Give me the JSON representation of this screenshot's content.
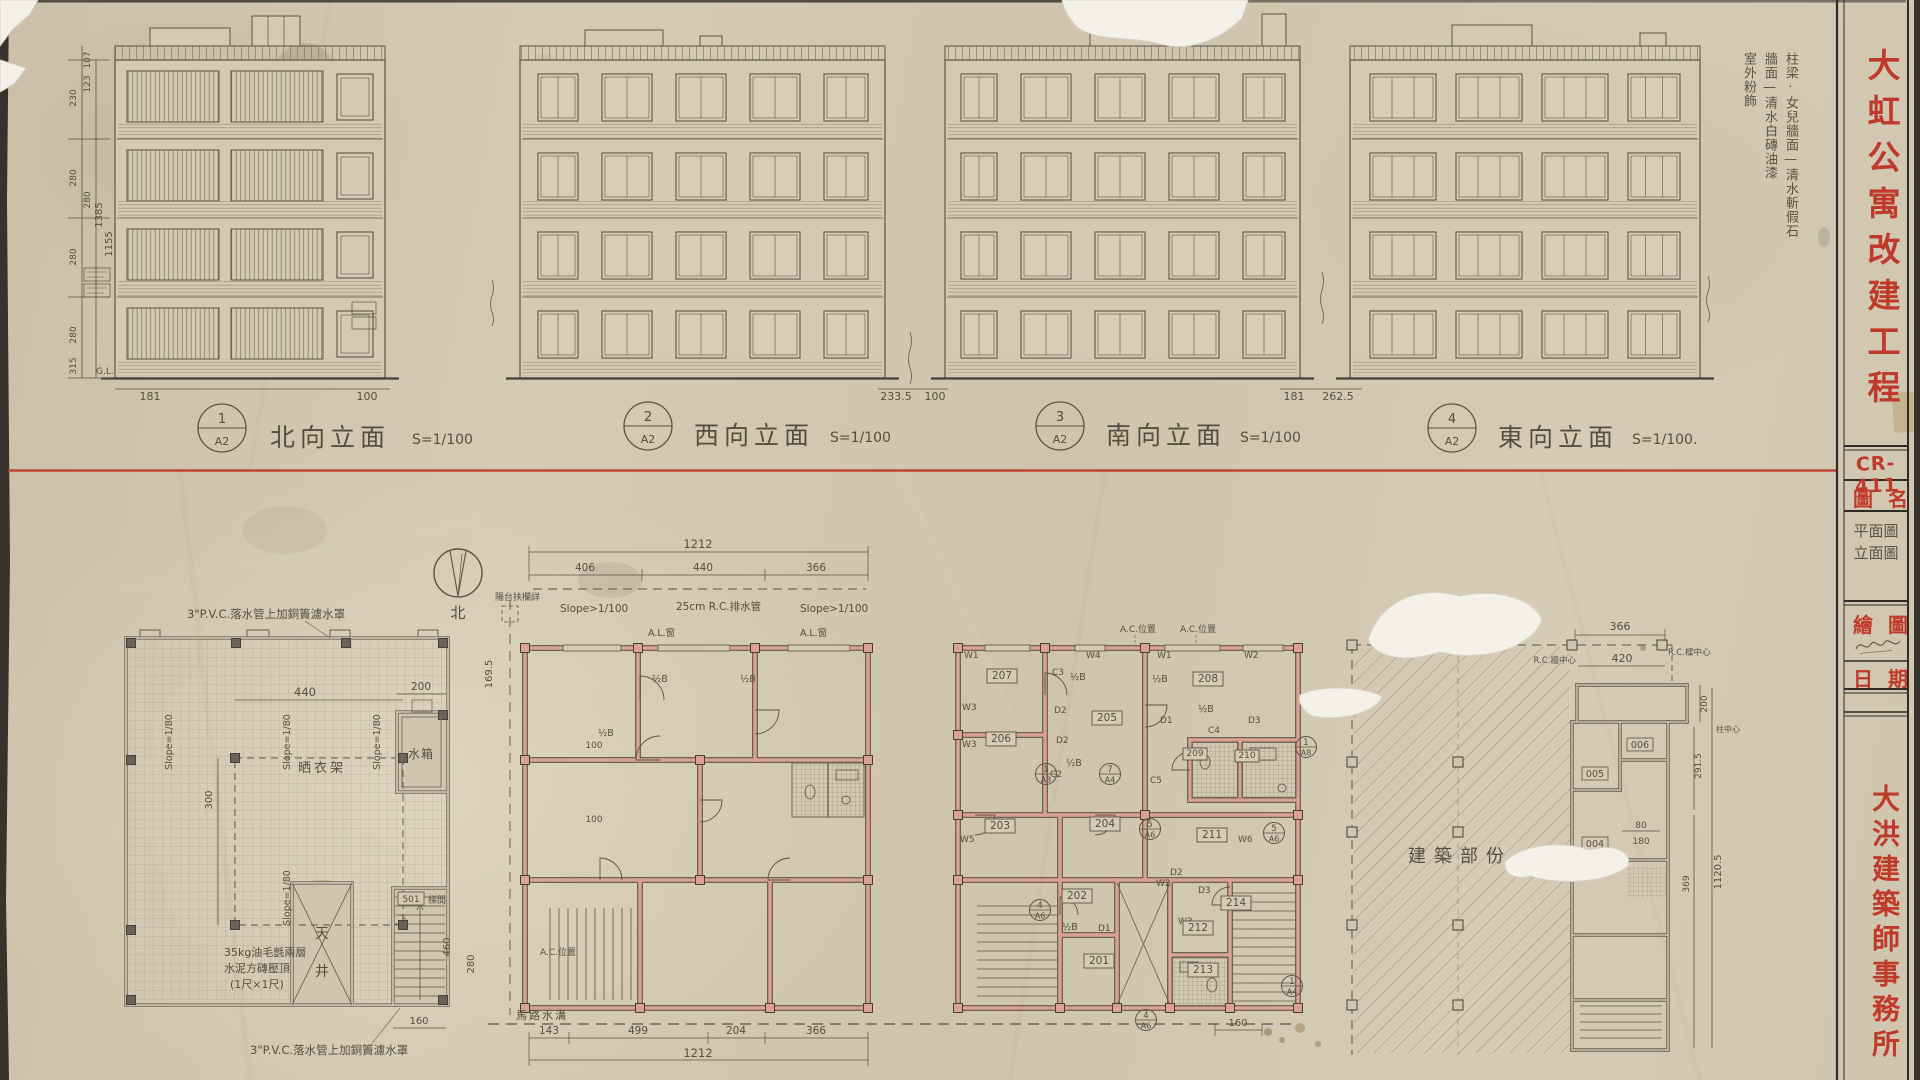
{
  "palette": {
    "paper": "#d0c5ae",
    "pencil": "#5b5347",
    "red": "#b5392b",
    "wall_pink": "#d9a18c"
  },
  "title_block": {
    "project_title": "大虹公寓改建工程",
    "drawing_no": "CR-411",
    "drawing_name_label": "圖名",
    "drawing_name_line1": "平面圖",
    "drawing_name_line2": "立面圖",
    "drawn_by_label": "繪圖",
    "date_label": "日期",
    "office_name": "大洪建築師事務所"
  },
  "finish_notes": {
    "col1": "柱梁·女兒牆面—清水斬假石",
    "col2": "牆面—清水白磚油漆",
    "col3": "室外粉飾"
  },
  "elevations": [
    {
      "num": "1",
      "sheet": "A2",
      "title": "北向立面",
      "scale": "S=1/100"
    },
    {
      "num": "2",
      "sheet": "A2",
      "title": "西向立面",
      "scale": "S=1/100"
    },
    {
      "num": "3",
      "sheet": "A2",
      "title": "南向立面",
      "scale": "S=1/100"
    },
    {
      "num": "4",
      "sheet": "A2",
      "title": "東向立面",
      "scale": "S=1/100."
    }
  ],
  "dims": {
    "left_strip": [
      "107",
      "123",
      "230",
      "280",
      "280",
      "280",
      "280",
      "1385",
      "1155",
      "315"
    ],
    "base": [
      "181",
      "100",
      "233.5",
      "100",
      "181",
      "262.5"
    ],
    "gl_label": "G.L."
  },
  "north_label": "北",
  "roof_plan": {
    "pvc_note": "3\"P.V.C.落水管上加銅簀濾水罩",
    "slope_note": "Slope=1/80",
    "drying_label": "晒衣架",
    "tank_label": "水箱",
    "well_char1": "天",
    "well_char2": "井",
    "stair_no": "501",
    "stair_label": "梯間",
    "down_label": "下",
    "coping_line1": "35kg油毛氈兩層",
    "coping_line2": "水泥方磚壓頂",
    "coping_line3": "(1尺×1尺)",
    "d440": "440",
    "d200": "200",
    "d300": "300",
    "d460": "460",
    "d160": "160"
  },
  "floor_plan": {
    "d1212": "1212",
    "d406": "406",
    "d440": "440",
    "d366": "366",
    "slope_note": "Slope>1/100",
    "pipe_note": "25cm R.C.排水管",
    "balcony_note": "陽台扶欄詳",
    "al_window": "A.L.窗",
    "half_b": "½B",
    "road_label": "馬路水溝",
    "d143": "143",
    "d499": "499",
    "d204": "204",
    "d100": "100",
    "d460": "460",
    "d280": "280",
    "d169": "169.5",
    "ac_note": "A.C.位置"
  },
  "ground_plan": {
    "rooms": [
      "201",
      "202",
      "203",
      "204",
      "205",
      "206",
      "207",
      "208",
      "209",
      "210",
      "211",
      "212",
      "213",
      "214"
    ],
    "marks": {
      "w1": "W1",
      "w2": "W2",
      "w3": "W3",
      "w4": "W4",
      "w5": "W5",
      "w6": "W6",
      "c2": "C2",
      "c3": "C3",
      "c4": "C4",
      "c5": "C5",
      "d1": "D1",
      "d2": "D2",
      "d3": "D3"
    },
    "ac_note": "A.C.位置",
    "half_b": "½B",
    "d160": "160",
    "refs": [
      {
        "num": "5",
        "sheet": "A6"
      },
      {
        "num": "4",
        "sheet": "A6"
      },
      {
        "num": "7",
        "sheet": "A4"
      },
      {
        "num": "1",
        "sheet": "A4"
      },
      {
        "num": "1",
        "sheet": "A8"
      },
      {
        "num": "1",
        "sheet": "A3"
      }
    ]
  },
  "site_plan": {
    "hatch_label": "建築部份",
    "rooms": [
      "004",
      "005",
      "006"
    ],
    "d366": "366",
    "d420": "420",
    "d200": "200",
    "d291": "291.5",
    "d369": "369",
    "d1120": "1120.5",
    "d80": "80",
    "d180": "180",
    "rc_wall_note": "R.C.牆中心",
    "rc_beam_note": "R.C.樑中心",
    "col_center_note": "柱中心"
  }
}
